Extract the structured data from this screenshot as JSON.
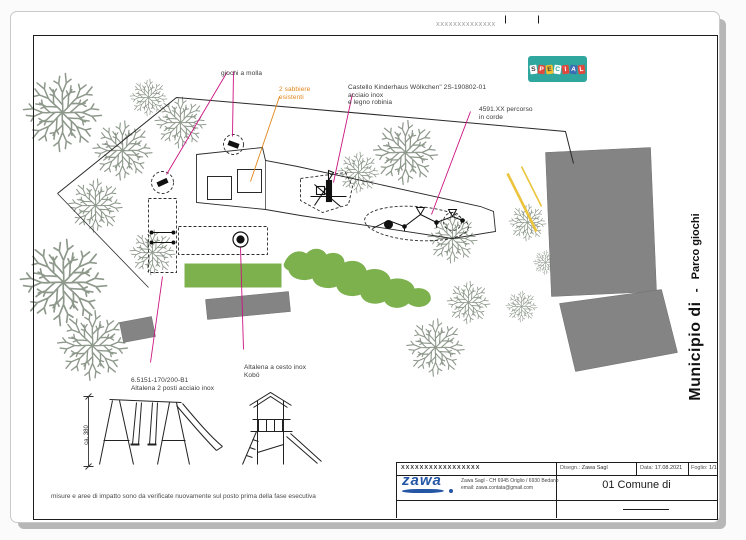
{
  "page": {
    "top_strip": {
      "placeholder": "XXXXXXXXXXXXXX"
    },
    "logo_special": {
      "letters": [
        "S",
        "P",
        "E",
        "C",
        "I",
        "A",
        "L"
      ]
    },
    "sidebar": {
      "title": "Municipio di",
      "dash": "-",
      "subtitle": "Parco giochi"
    },
    "note": "misure e aree di impatto sono da verificate nuovamente sul posto prima della fase esecutiva"
  },
  "annotations": {
    "giochi_molla": {
      "text": "giochi a molla"
    },
    "sabbiere": {
      "line1": "2 sabbiere",
      "line2": "esistenti"
    },
    "castello": {
      "line1": "Castello Kinderhaus Wölkchen\" 2S-190802-01",
      "line2": "acciaio inox",
      "line3": "e legno robinia"
    },
    "percorso": {
      "line1": "4591.XX percorso",
      "line2": "in corde"
    },
    "altalena_due": {
      "line1": "6.5151-170/200-B1",
      "line2": "Altalena 2 posti acciaio inox"
    },
    "altalena_cesto": {
      "line1": "Altalena a cesto inox",
      "line2": "Kobö"
    },
    "dimension": "ca. 380"
  },
  "titleblock": {
    "placeholder": "XXXXXXXXXXXXXXXXX",
    "disegn_label": "Disegn.:",
    "disegn_value": "Zawa Sagl",
    "data_label": "Data:",
    "data_value": "17.08.2021",
    "foglio_label": "Foglio:",
    "foglio_value": "1/1",
    "logo_text": "zawa",
    "address": "Zawa Sagl - CH 6945 Origlio / 6930 Bedano",
    "email": "email: zawa.contata@gmail.com",
    "title": "01 Comune di"
  },
  "colors": {
    "logo_teal": "#2fa79f",
    "zawa_blue": "#2456a4",
    "leader_magenta": "#cb1380",
    "existing_orange": "#e0861c",
    "grass_green": "#7cb14e",
    "building_gray": "#848484",
    "tree_gray": "#8e998c",
    "accent_yellow": "#ecc43c"
  }
}
